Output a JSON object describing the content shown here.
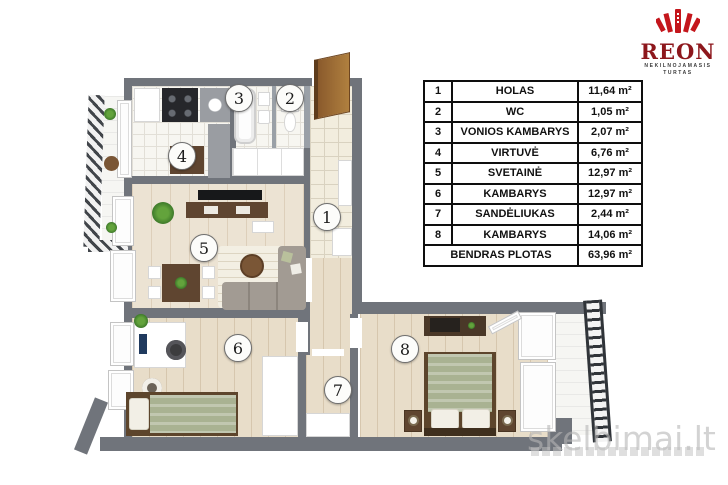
{
  "branding": {
    "logo_name": "REON",
    "logo_subtitle_line1": "NEKILNOJAMASIS",
    "logo_subtitle_line2": "TURTAS",
    "colors": {
      "emblem_red": "#c4161c",
      "logo_text": "#8d171c"
    }
  },
  "watermark": {
    "text": "skelbimai.lt"
  },
  "area_table": {
    "rows": [
      {
        "num": "1",
        "name": "HOLAS",
        "area": "11,64 m²"
      },
      {
        "num": "2",
        "name": "WC",
        "area": "1,05 m²"
      },
      {
        "num": "3",
        "name": "VONIOS KAMBARYS",
        "area": "2,07 m²"
      },
      {
        "num": "4",
        "name": "VIRTUVĖ",
        "area": "6,76 m²"
      },
      {
        "num": "5",
        "name": "SVETAINĖ",
        "area": "12,97 m²"
      },
      {
        "num": "6",
        "name": "KAMBARYS",
        "area": "12,97 m²"
      },
      {
        "num": "7",
        "name": "SANDĖLIUKAS",
        "area": "2,44 m²"
      },
      {
        "num": "8",
        "name": "KAMBARYS",
        "area": "14,06 m²"
      }
    ],
    "total": {
      "label": "BENDRAS PLOTAS",
      "area": "63,96 m²"
    }
  },
  "plan": {
    "room_markers": [
      {
        "label": "1"
      },
      {
        "label": "2"
      },
      {
        "label": "3"
      },
      {
        "label": "4"
      },
      {
        "label": "5"
      },
      {
        "label": "6"
      },
      {
        "label": "7"
      },
      {
        "label": "8"
      }
    ],
    "colors": {
      "wall": "#70747b",
      "wood_floor": "#e8ddc9",
      "tile_floor": "#f2edde"
    }
  }
}
